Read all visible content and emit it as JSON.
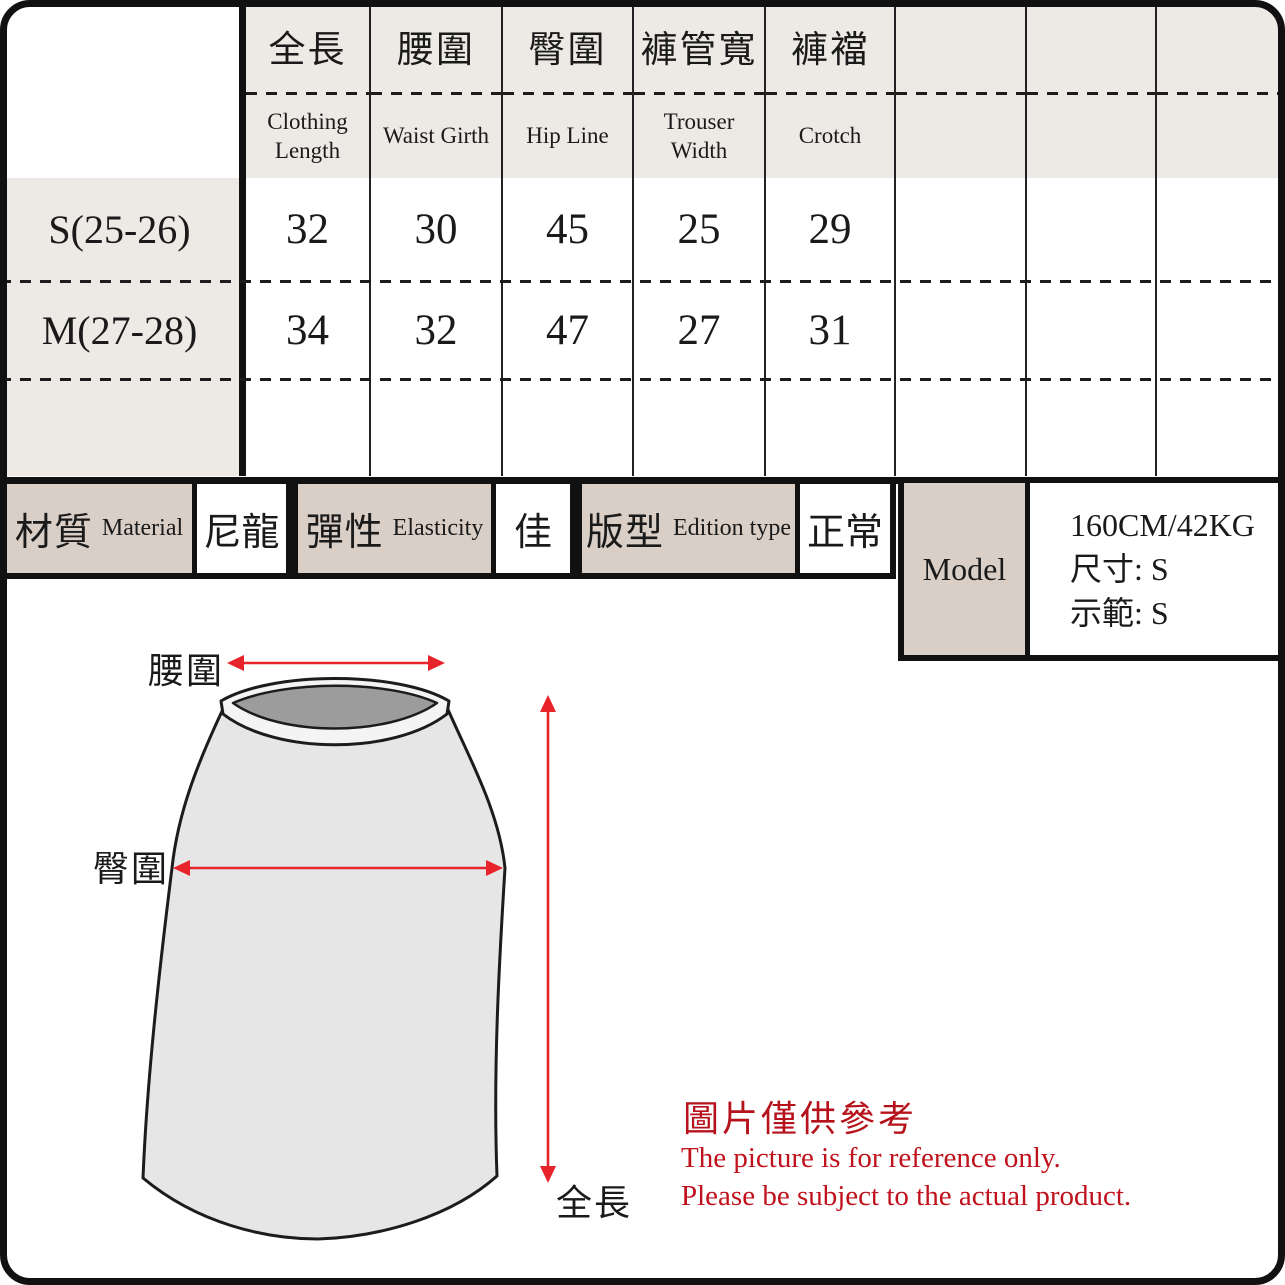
{
  "size_table": {
    "columns": [
      {
        "zh": "全長",
        "en": "Clothing Length"
      },
      {
        "zh": "腰圍",
        "en": "Waist Girth"
      },
      {
        "zh": "臀圍",
        "en": "Hip Line"
      },
      {
        "zh": "褲管寬",
        "en": "Trouser Width"
      },
      {
        "zh": "褲襠",
        "en": "Crotch"
      },
      {
        "zh": "",
        "en": ""
      },
      {
        "zh": "",
        "en": ""
      },
      {
        "zh": "",
        "en": ""
      }
    ],
    "rows": [
      {
        "size": "S(25-26)",
        "values": [
          "32",
          "30",
          "45",
          "25",
          "29",
          "",
          "",
          ""
        ]
      },
      {
        "size": "M(27-28)",
        "values": [
          "34",
          "32",
          "47",
          "27",
          "31",
          "",
          "",
          ""
        ]
      },
      {
        "size": "",
        "values": [
          "",
          "",
          "",
          "",
          "",
          "",
          "",
          ""
        ]
      }
    ]
  },
  "attributes": [
    {
      "zh": "材質",
      "en": "Material",
      "value": "尼龍"
    },
    {
      "zh": "彈性",
      "en": "Elasticity",
      "value": "佳"
    },
    {
      "zh": "版型",
      "en": "Edition type",
      "value": "正常"
    }
  ],
  "model": {
    "label": "Model",
    "stats": "160CM/42KG",
    "size_line": "尺寸:  S",
    "demo_line": "示範:  S"
  },
  "diagram": {
    "waist_label": "腰圍",
    "hip_label": "臀圍",
    "length_label": "全長"
  },
  "disclaimer": {
    "zh": "圖片僅供參考",
    "en1": "The picture is for reference only.",
    "en2": "Please be subject to the actual product."
  },
  "colors": {
    "header_bg": "#edeae5",
    "attr_label_bg": "#d9cfc7",
    "grid_line": "#111111",
    "red_text": "#b5121b",
    "arrow_red": "#e8242b",
    "skirt_fill": "#e6e6e6",
    "waistband_inner": "#9c9c9c"
  }
}
